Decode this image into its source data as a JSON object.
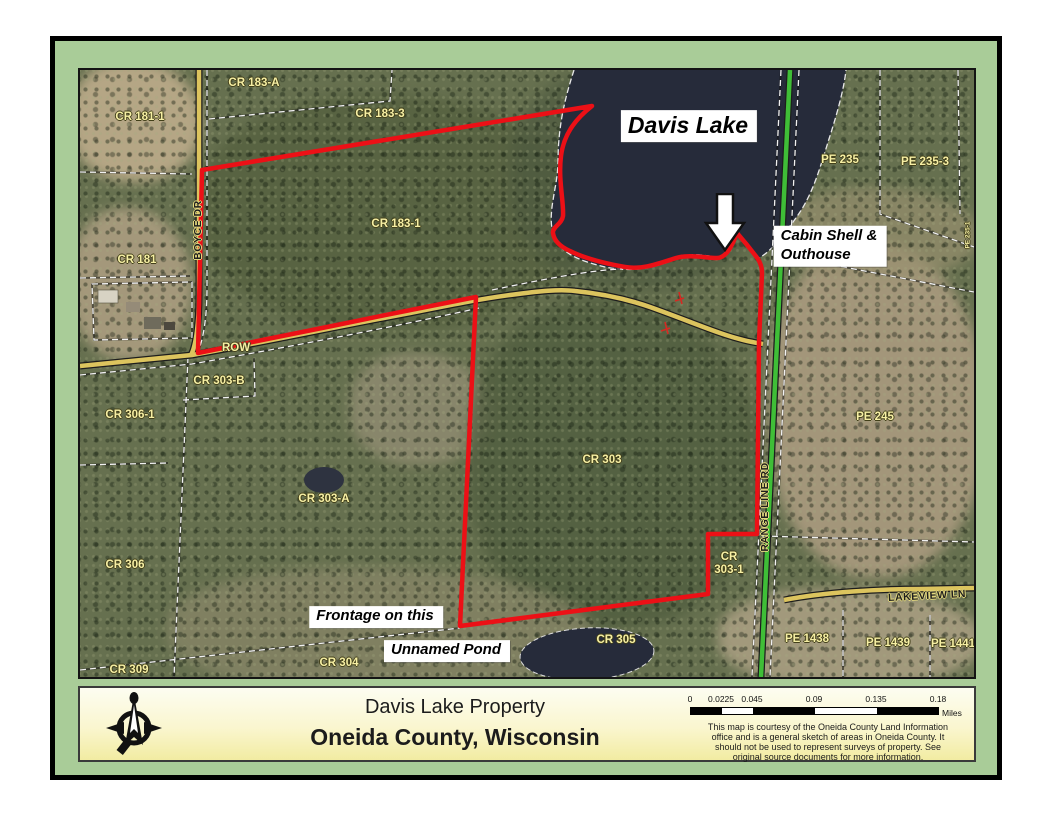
{
  "colors": {
    "mat": "#a9cc98",
    "boundary_red": "#ec1016",
    "road_yellow": "#dcc45e",
    "road_green": "#3fbe37",
    "lake": "#262b3a",
    "parcel_label_yellow": "#f6efa4"
  },
  "map": {
    "labels": [
      {
        "name": "parcel-label-cr-181-1",
        "kind": "parcel",
        "text": "CR 181-1",
        "x": 60,
        "y": 47
      },
      {
        "name": "parcel-label-cr-183-a",
        "kind": "parcel",
        "text": "CR 183-A",
        "x": 174,
        "y": 13
      },
      {
        "name": "parcel-label-cr-183-3",
        "kind": "parcel",
        "text": "CR 183-3",
        "x": 300,
        "y": 44
      },
      {
        "name": "parcel-label-cr-183-1",
        "kind": "parcel",
        "text": "CR 183-1",
        "x": 316,
        "y": 154
      },
      {
        "name": "parcel-label-cr-181",
        "kind": "parcel",
        "text": "CR 181",
        "x": 57,
        "y": 190
      },
      {
        "name": "parcel-label-pe-235",
        "kind": "parcel",
        "text": "PE 235",
        "x": 760,
        "y": 90
      },
      {
        "name": "parcel-label-pe-235-3",
        "kind": "parcel",
        "text": "PE 235-3",
        "x": 845,
        "y": 92
      },
      {
        "name": "parcel-label-pe-235-1",
        "kind": "parcel",
        "text": "PE 235-1",
        "x": 888,
        "y": 165,
        "rotate": -90,
        "size": 6.5
      },
      {
        "name": "row-label",
        "kind": "parcel",
        "text": "ROW",
        "x": 156,
        "y": 278
      },
      {
        "name": "parcel-label-cr-303-b",
        "kind": "parcel",
        "text": "CR 303-B",
        "x": 139,
        "y": 311
      },
      {
        "name": "parcel-label-cr-306-1",
        "kind": "parcel",
        "text": "CR 306-1",
        "x": 50,
        "y": 345
      },
      {
        "name": "parcel-label-cr-303-a",
        "kind": "parcel",
        "text": "CR 303-A",
        "x": 244,
        "y": 429
      },
      {
        "name": "parcel-label-cr-303",
        "kind": "parcel",
        "text": "CR 303",
        "x": 522,
        "y": 390
      },
      {
        "name": "parcel-label-pe-245",
        "kind": "parcel",
        "text": "PE 245",
        "x": 795,
        "y": 347
      },
      {
        "name": "parcel-label-cr-306",
        "kind": "parcel",
        "text": "CR 306",
        "x": 45,
        "y": 495
      },
      {
        "name": "parcel-label-cr-303-1-line1",
        "kind": "parcel",
        "text": "CR",
        "x": 649,
        "y": 487
      },
      {
        "name": "parcel-label-cr-303-1-line2",
        "kind": "parcel",
        "text": "303-1",
        "x": 649,
        "y": 500
      },
      {
        "name": "parcel-label-cr-309",
        "kind": "parcel",
        "text": "CR 309",
        "x": 49,
        "y": 600
      },
      {
        "name": "parcel-label-cr-304",
        "kind": "parcel",
        "text": "CR 304",
        "x": 259,
        "y": 593
      },
      {
        "name": "parcel-label-cr-305",
        "kind": "parcel",
        "text": "CR 305",
        "x": 536,
        "y": 570
      },
      {
        "name": "parcel-label-pe-1438",
        "kind": "parcel",
        "text": "PE 1438",
        "x": 727,
        "y": 569
      },
      {
        "name": "parcel-label-pe-1439",
        "kind": "parcel",
        "text": "PE 1439",
        "x": 808,
        "y": 573
      },
      {
        "name": "parcel-label-pe-1441",
        "kind": "parcel",
        "text": "PE 1441",
        "x": 873,
        "y": 574
      },
      {
        "name": "road-label-boyce-dr",
        "kind": "road",
        "text": "BOYCE DR",
        "x": 118,
        "y": 160,
        "rotate": -90
      },
      {
        "name": "road-label-range-line-rd",
        "kind": "road",
        "text": "RANGE LINE RD",
        "x": 685,
        "y": 437,
        "rotate": -90
      },
      {
        "name": "road-label-lakeview-ln",
        "kind": "road",
        "text": "LAKEVIEW LN",
        "x": 847,
        "y": 526,
        "rotate": -3
      }
    ],
    "annotations": [
      {
        "name": "davis-lake-label",
        "lines": [
          "Davis Lake"
        ],
        "x": 609,
        "y": 56,
        "size": 23
      },
      {
        "name": "cabin-shell-outhouse-label",
        "lines": [
          "Cabin Shell &",
          "Outhouse"
        ],
        "x": 750,
        "y": 176,
        "size": 15
      },
      {
        "name": "frontage-label",
        "lines": [
          "Frontage on this"
        ],
        "x": 296,
        "y": 547,
        "size": 15
      },
      {
        "name": "unnamed-pond-label",
        "lines": [
          "Unnamed Pond"
        ],
        "x": 367,
        "y": 581,
        "size": 15
      }
    ]
  },
  "footer": {
    "title": "Davis Lake Property",
    "subtitle": "Oneida County, Wisconsin",
    "scale": {
      "ticks": [
        {
          "label": "0",
          "x": 0
        },
        {
          "label": "0.0225",
          "x": 31
        },
        {
          "label": "0.045",
          "x": 62
        },
        {
          "label": "0.09",
          "x": 124
        },
        {
          "label": "0.135",
          "x": 186
        },
        {
          "label": "0.18",
          "x": 248
        }
      ],
      "unit": "Miles"
    },
    "disclaimer_lines": [
      "This map is courtesy of the Oneida County Land Information",
      "office and is a general sketch of areas in Oneida County.  It",
      "should not be used to represent surveys of property.  See",
      "original source documents for more information."
    ]
  }
}
